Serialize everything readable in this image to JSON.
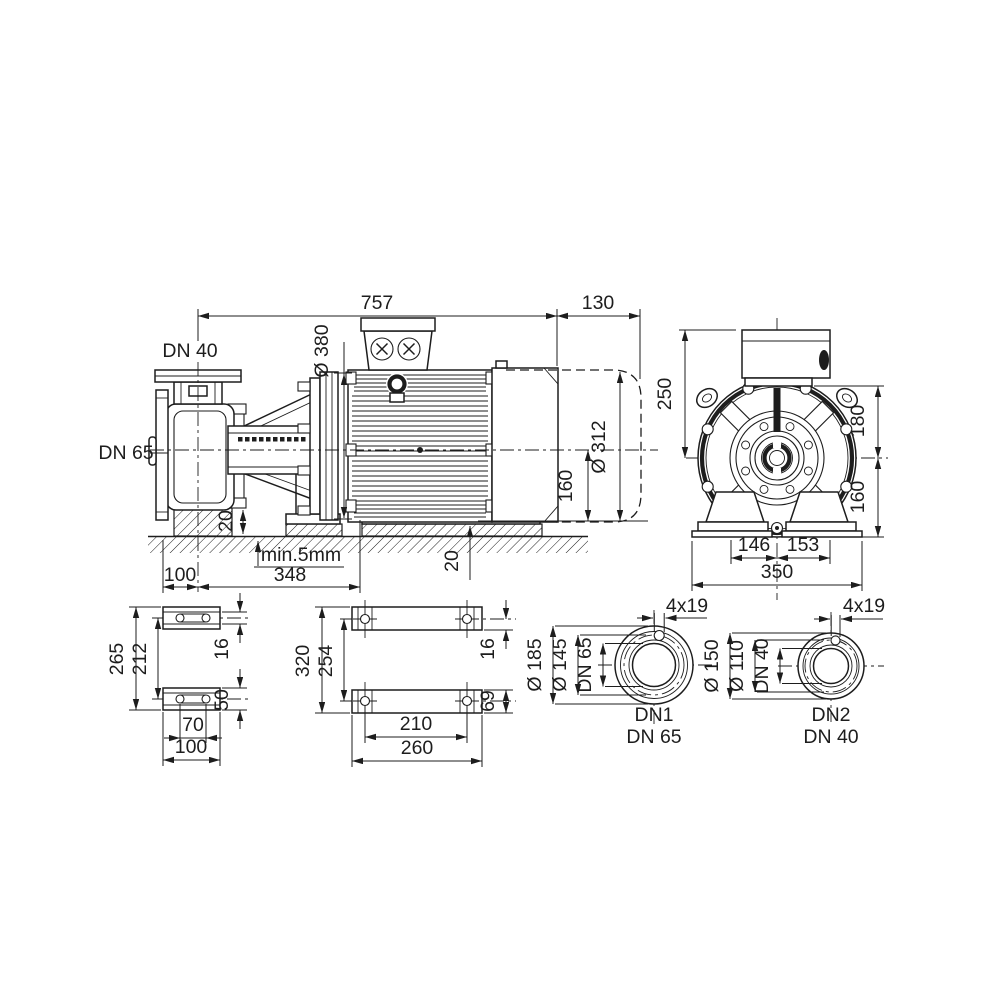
{
  "drawing": {
    "line_color": "#1d1d1d",
    "background": "#ffffff",
    "side_view": {
      "labels": {
        "discharge_port": "DN 40",
        "suction_port": "DN 65"
      },
      "dims": {
        "overall_length": "757",
        "dismantling_space": "130",
        "motor_flange_dia": "Ø 380",
        "motor_dia": "Ø 312",
        "shaft_height": "160",
        "pedestal_height": "20",
        "foot_pad_height": "20",
        "grout_note": "min.5mm",
        "center_to_foot": "348",
        "foot_offset": "100"
      }
    },
    "end_view": {
      "dims": {
        "center_to_box_top": "250",
        "flange_to_center": "180",
        "center_to_base": "160",
        "left_foot_offset": "146",
        "right_foot_offset": "153",
        "base_width": "350"
      }
    },
    "pump_foot_view": {
      "dims": {
        "overall_length": "265",
        "hole_spacing": "212",
        "web_thickness": "16",
        "foot_width": "50",
        "slot_spacing": "70",
        "foot_length": "100"
      }
    },
    "motor_foot_view": {
      "dims": {
        "overall_length": "320",
        "hole_spacing": "254",
        "edge_offset": "16",
        "foot_width": "69",
        "hole_pitch": "210",
        "foot_length": "260"
      }
    },
    "flange_dn1": {
      "dims": {
        "bolt_holes": "4x19",
        "outer_dia": "Ø 185",
        "bolt_circle_dia": "Ø 145",
        "nominal_dia": "DN 65"
      },
      "caption": {
        "line1": "DN1",
        "line2": "DN 65"
      }
    },
    "flange_dn2": {
      "dims": {
        "bolt_holes": "4x19",
        "outer_dia": "Ø 150",
        "bolt_circle_dia": "Ø 110",
        "nominal_dia": "DN 40"
      },
      "caption": {
        "line1": "DN2",
        "line2": "DN 40"
      }
    }
  }
}
